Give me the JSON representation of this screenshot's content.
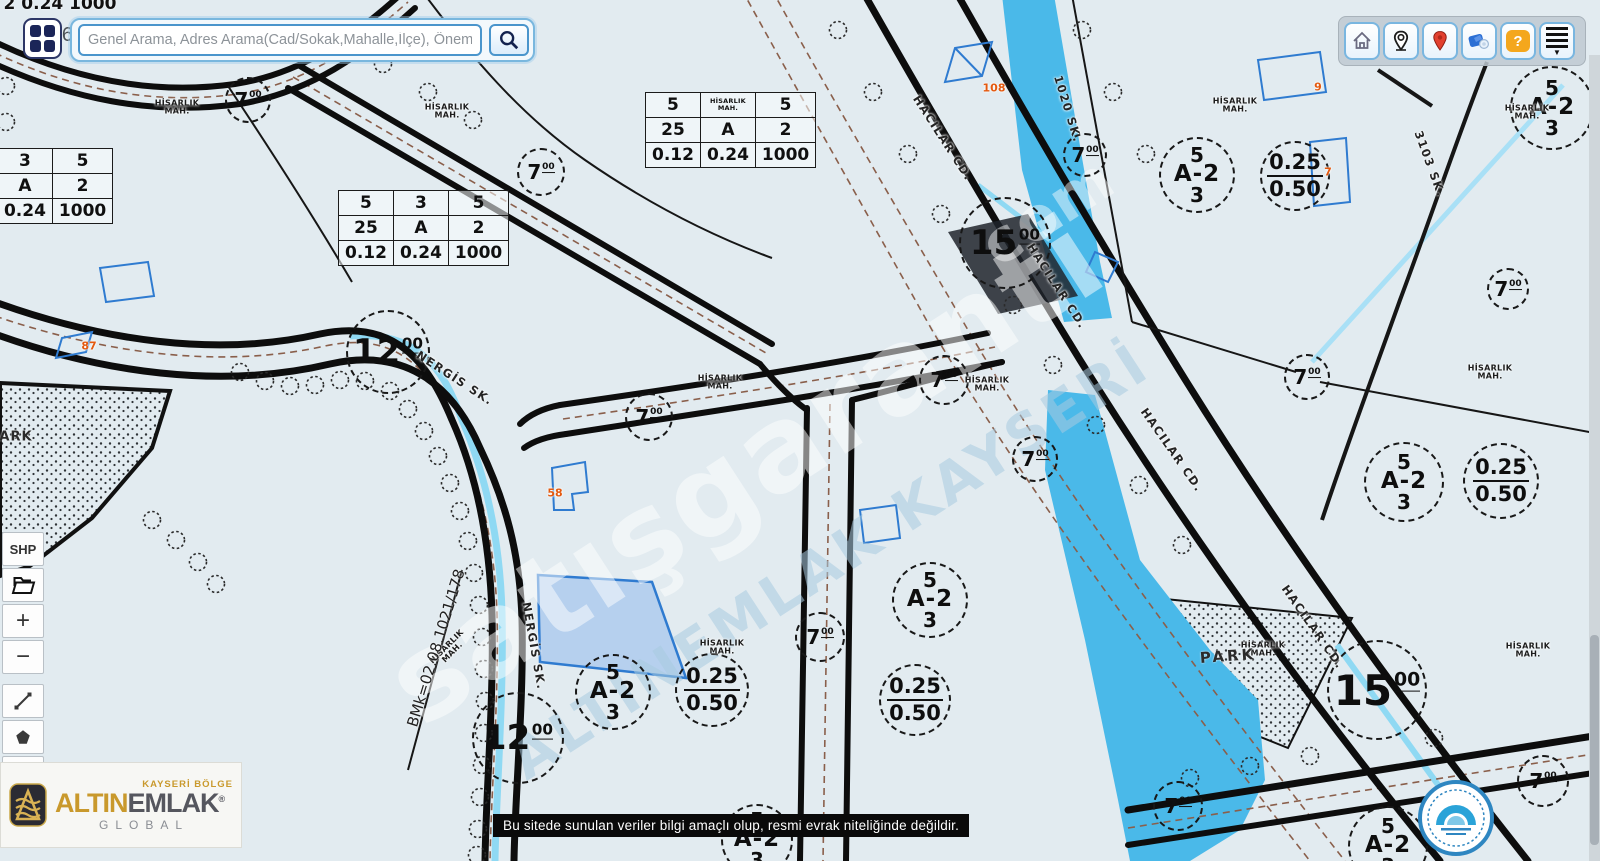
{
  "page": {
    "ref_id": "#1269216677"
  },
  "search": {
    "placeholder": "Genel Arama, Adres Arama(Cad/Sokak,Mahalle,İlçe), Önemli Yer Aram"
  },
  "top_toolbar": {
    "buttons": [
      "home",
      "my-location",
      "marker",
      "panorama",
      "help",
      "menu"
    ],
    "help_glyph": "?"
  },
  "left_toolbar": {
    "shp": "SHP",
    "zoom_in": "+",
    "zoom_out": "−"
  },
  "brand": {
    "region": "KAYSERİ BÖLGE",
    "name_gold": "ALTIN",
    "name_dark": "EMLAK",
    "reg_mark": "®",
    "sub": "GLOBAL"
  },
  "disclaimer": "Bu sitede sunulan veriler bilgi amaçlı olup, resmi evrak niteliğinde değildir.",
  "map": {
    "district_text": [
      "HİSARLIK",
      "MAH."
    ],
    "tables": [
      {
        "x": 338,
        "y": 190,
        "rows": [
          [
            "5",
            "3",
            "5"
          ],
          [
            "25",
            "A",
            "2"
          ],
          [
            "0.12",
            "0.24",
            "1000"
          ]
        ]
      },
      {
        "x": 645,
        "y": 92,
        "rows": [
          [
            "5",
            "HİSARLIK MAH.",
            "5"
          ],
          [
            "25",
            "A",
            "2"
          ],
          [
            "0.12",
            "0.24",
            "1000"
          ]
        ]
      },
      {
        "x": -58,
        "y": 148,
        "rows": [
          [
            "5",
            "3",
            "5"
          ],
          [
            "25",
            "A",
            "2"
          ],
          [
            "0.12",
            "0.24",
            "1000"
          ]
        ]
      }
    ],
    "road_widths": [
      {
        "x": 248,
        "y": 100,
        "r": 23,
        "n": "7",
        "sup": "00"
      },
      {
        "x": 541,
        "y": 172,
        "r": 24,
        "n": "7",
        "sup": "00"
      },
      {
        "x": 1005,
        "y": 243,
        "r": 46,
        "n": "15",
        "sup": "00"
      },
      {
        "x": 1085,
        "y": 155,
        "r": 22,
        "n": "7",
        "sup": "00"
      },
      {
        "x": 388,
        "y": 352,
        "r": 42,
        "n": "12",
        "sup": "00"
      },
      {
        "x": 649,
        "y": 417,
        "r": 24,
        "n": "7",
        "sup": "00"
      },
      {
        "x": 944,
        "y": 380,
        "r": 25,
        "n": "7",
        "sup": "00"
      },
      {
        "x": 1035,
        "y": 459,
        "r": 23,
        "n": "7",
        "sup": "00"
      },
      {
        "x": 1307,
        "y": 377,
        "r": 23,
        "n": "7",
        "sup": "00"
      },
      {
        "x": 1508,
        "y": 289,
        "r": 21,
        "n": "7",
        "sup": "00"
      },
      {
        "x": 820,
        "y": 637,
        "r": 25,
        "n": "7",
        "sup": "00"
      },
      {
        "x": 518,
        "y": 738,
        "r": 46,
        "n": "12",
        "sup": "00"
      },
      {
        "x": 1377,
        "y": 690,
        "r": 50,
        "n": "15",
        "sup": "00"
      },
      {
        "x": 1178,
        "y": 806,
        "r": 25,
        "n": "7",
        "sup": "00"
      },
      {
        "x": 1543,
        "y": 781,
        "r": 26,
        "n": "7",
        "sup": "00"
      }
    ],
    "zone_circles": [
      {
        "x": 1197,
        "y": 175,
        "r": 38,
        "top": "5",
        "mid": "A-2",
        "bot": "3"
      },
      {
        "x": 1404,
        "y": 482,
        "r": 40,
        "top": "5",
        "mid": "A-2",
        "bot": "3"
      },
      {
        "x": 930,
        "y": 600,
        "r": 38,
        "top": "5",
        "mid": "A-2",
        "bot": "3"
      },
      {
        "x": 613,
        "y": 692,
        "r": 38,
        "top": "5",
        "mid": "A-2",
        "bot": "3"
      },
      {
        "x": 1552,
        "y": 108,
        "r": 42,
        "top": "5",
        "mid": "A-2",
        "bot": "3"
      },
      {
        "x": 1388,
        "y": 846,
        "r": 40,
        "top": "5",
        "mid": "A-2",
        "bot": "3"
      },
      {
        "x": 757,
        "y": 840,
        "r": 36,
        "top": "5",
        "mid": "A-2",
        "bot": "3"
      }
    ],
    "ratio_circles": [
      {
        "x": 1295,
        "y": 176,
        "r": 35,
        "top": "0.25",
        "bot": "0.50"
      },
      {
        "x": 1501,
        "y": 481,
        "r": 38,
        "top": "0.25",
        "bot": "0.50"
      },
      {
        "x": 712,
        "y": 690,
        "r": 37,
        "top": "0.25",
        "bot": "0.50"
      },
      {
        "x": 915,
        "y": 700,
        "r": 36,
        "top": "0.25",
        "bot": "0.50"
      }
    ],
    "district_labels": [
      {
        "x": 177,
        "y": 108
      },
      {
        "x": 447,
        "y": 112
      },
      {
        "x": 1235,
        "y": 106
      },
      {
        "x": 1527,
        "y": 113
      },
      {
        "x": 720,
        "y": 383
      },
      {
        "x": 987,
        "y": 385
      },
      {
        "x": 1490,
        "y": 373
      },
      {
        "x": 450,
        "y": 650,
        "rot": -45
      },
      {
        "x": 722,
        "y": 648
      },
      {
        "x": 1263,
        "y": 650
      },
      {
        "x": 1528,
        "y": 651
      }
    ],
    "street_labels": [
      {
        "text": "HACILAR CD.",
        "x": 943,
        "y": 138,
        "rot": 57
      },
      {
        "text": "HACILAR CD.",
        "x": 1057,
        "y": 286,
        "rot": 57
      },
      {
        "text": "HACILAR CD.",
        "x": 1172,
        "y": 450,
        "rot": 55
      },
      {
        "text": "HACILAR CD.",
        "x": 1313,
        "y": 627,
        "rot": 55
      },
      {
        "text": "NERGİS SK.",
        "x": 455,
        "y": 378,
        "rot": 33
      },
      {
        "text": "NERGİS SK.",
        "x": 534,
        "y": 646,
        "rot": 80
      },
      {
        "text": "1020 SK.",
        "x": 1068,
        "y": 109,
        "rot": 73
      },
      {
        "text": "3103 SK.",
        "x": 1430,
        "y": 164,
        "rot": 70
      }
    ],
    "building_numbers": [
      {
        "text": "87",
        "x": 89,
        "y": 346
      },
      {
        "text": "58",
        "x": 555,
        "y": 493
      },
      {
        "text": "108",
        "x": 994,
        "y": 88
      },
      {
        "text": "9",
        "x": 1318,
        "y": 87
      },
      {
        "text": "7",
        "x": 1328,
        "y": 172
      }
    ],
    "misc_labels": [
      {
        "text": "PARK",
        "x": 1228,
        "y": 656,
        "size": 15,
        "spacing": 3,
        "weight": 700,
        "color": "#2b2b2b",
        "rot": -4
      },
      {
        "text": "ARK",
        "x": 16,
        "y": 437,
        "size": 13,
        "spacing": 1,
        "weight": 700,
        "color": "#2b2b2b",
        "rot": 0
      },
      {
        "text": "BMk=02.08.1021/178",
        "x": 436,
        "y": 648,
        "rot": -73,
        "size": 15,
        "weight": 400,
        "color": "#1f1f1f",
        "spacing": 0
      },
      {
        "text": "2 0.24 1000",
        "x": 60,
        "y": 4,
        "size": 17,
        "weight": 700,
        "color": "#111111",
        "rot": 0,
        "spacing": 0
      }
    ],
    "watermarks": [
      {
        "text": "satışgaranti",
        "x": 745,
        "y": 470,
        "rot": -33,
        "size": 118,
        "color": "#ffffff",
        "opacity": 0.5,
        "spacing": 2
      },
      {
        "text": "com",
        "x": 1048,
        "y": 212,
        "rot": -33,
        "size": 60,
        "color": "#ffffff",
        "opacity": 0.45,
        "spacing": 2
      },
      {
        "text": "ALTINEMLAK KAYSERİ",
        "x": 830,
        "y": 562,
        "rot": -33,
        "size": 56,
        "color": "#a8cbe0",
        "opacity": 0.55,
        "spacing": 4
      }
    ]
  }
}
